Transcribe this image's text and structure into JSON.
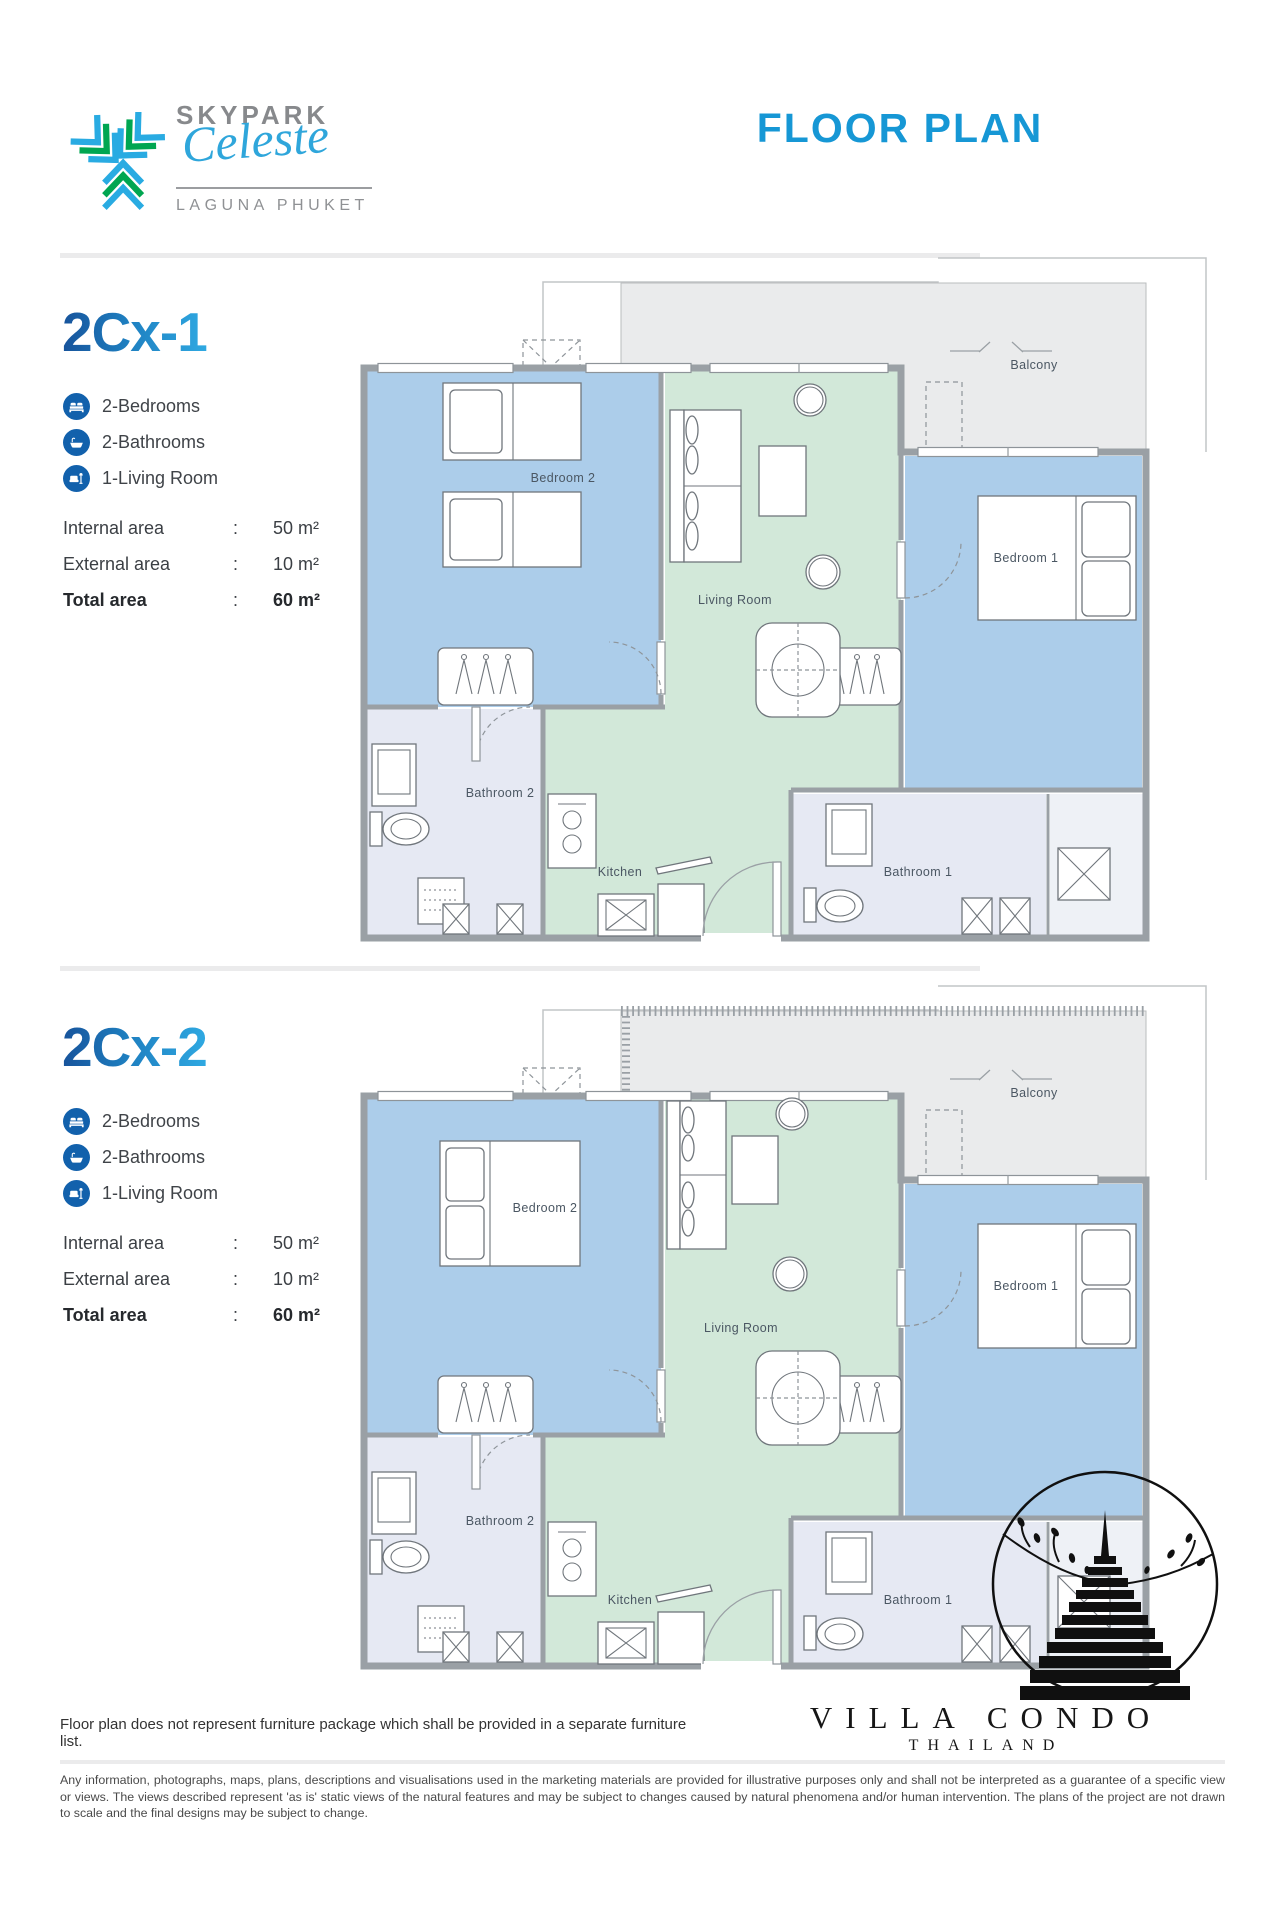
{
  "brand": {
    "name": "SKYPARK",
    "script": "Celeste",
    "location": "LAGUNA PHUKET"
  },
  "page_title": "FLOOR PLAN",
  "misc": {
    "colon": ":"
  },
  "units": [
    {
      "code": "2Cx-1",
      "features": [
        {
          "icon": "bed-icon",
          "label": "2-Bedrooms"
        },
        {
          "icon": "bathtub-icon",
          "label": "2-Bathrooms"
        },
        {
          "icon": "sofa-icon",
          "label": "1-Living Room"
        }
      ],
      "areas": {
        "internal": {
          "label": "Internal area",
          "value": "50 m²"
        },
        "external": {
          "label": "External area",
          "value": "10 m²"
        },
        "total": {
          "label": "Total area",
          "value": "60 m²"
        }
      },
      "rooms": {
        "balcony": "Balcony",
        "bedroom2": "Bedroom 2",
        "bedroom1": "Bedroom 1",
        "living": "Living Room",
        "kitchen": "Kitchen",
        "bath1": "Bathroom 1",
        "bath2": "Bathroom 2"
      }
    },
    {
      "code": "2Cx-2",
      "features": [
        {
          "icon": "bed-icon",
          "label": "2-Bedrooms"
        },
        {
          "icon": "bathtub-icon",
          "label": "2-Bathrooms"
        },
        {
          "icon": "sofa-icon",
          "label": "1-Living Room"
        }
      ],
      "areas": {
        "internal": {
          "label": "Internal area",
          "value": "50 m²"
        },
        "external": {
          "label": "External area",
          "value": "10 m²"
        },
        "total": {
          "label": "Total area",
          "value": "60 m²"
        }
      },
      "rooms": {
        "balcony": "Balcony",
        "bedroom2": "Bedroom 2",
        "bedroom1": "Bedroom 1",
        "living": "Living Room",
        "kitchen": "Kitchen",
        "bath1": "Bathroom 1",
        "bath2": "Bathroom 2"
      }
    }
  ],
  "footer": {
    "note": "Floor plan does not represent furniture package which shall be provided in a separate furniture list.",
    "logo_line1": "VILLA CONDO",
    "logo_line2": "THAILAND",
    "disclaimer": "Any information, photographs, maps, plans, descriptions and visualisations used in the marketing materials are provided for illustrative purposes only and shall not be interpreted as a guarantee of a specific view or views. The views described represent 'as is' static views of the natural features and may be subject to changes caused by natural phenomena and/or human intervention. The plans of the project are not drawn to scale and the final designs may be subject to change."
  }
}
